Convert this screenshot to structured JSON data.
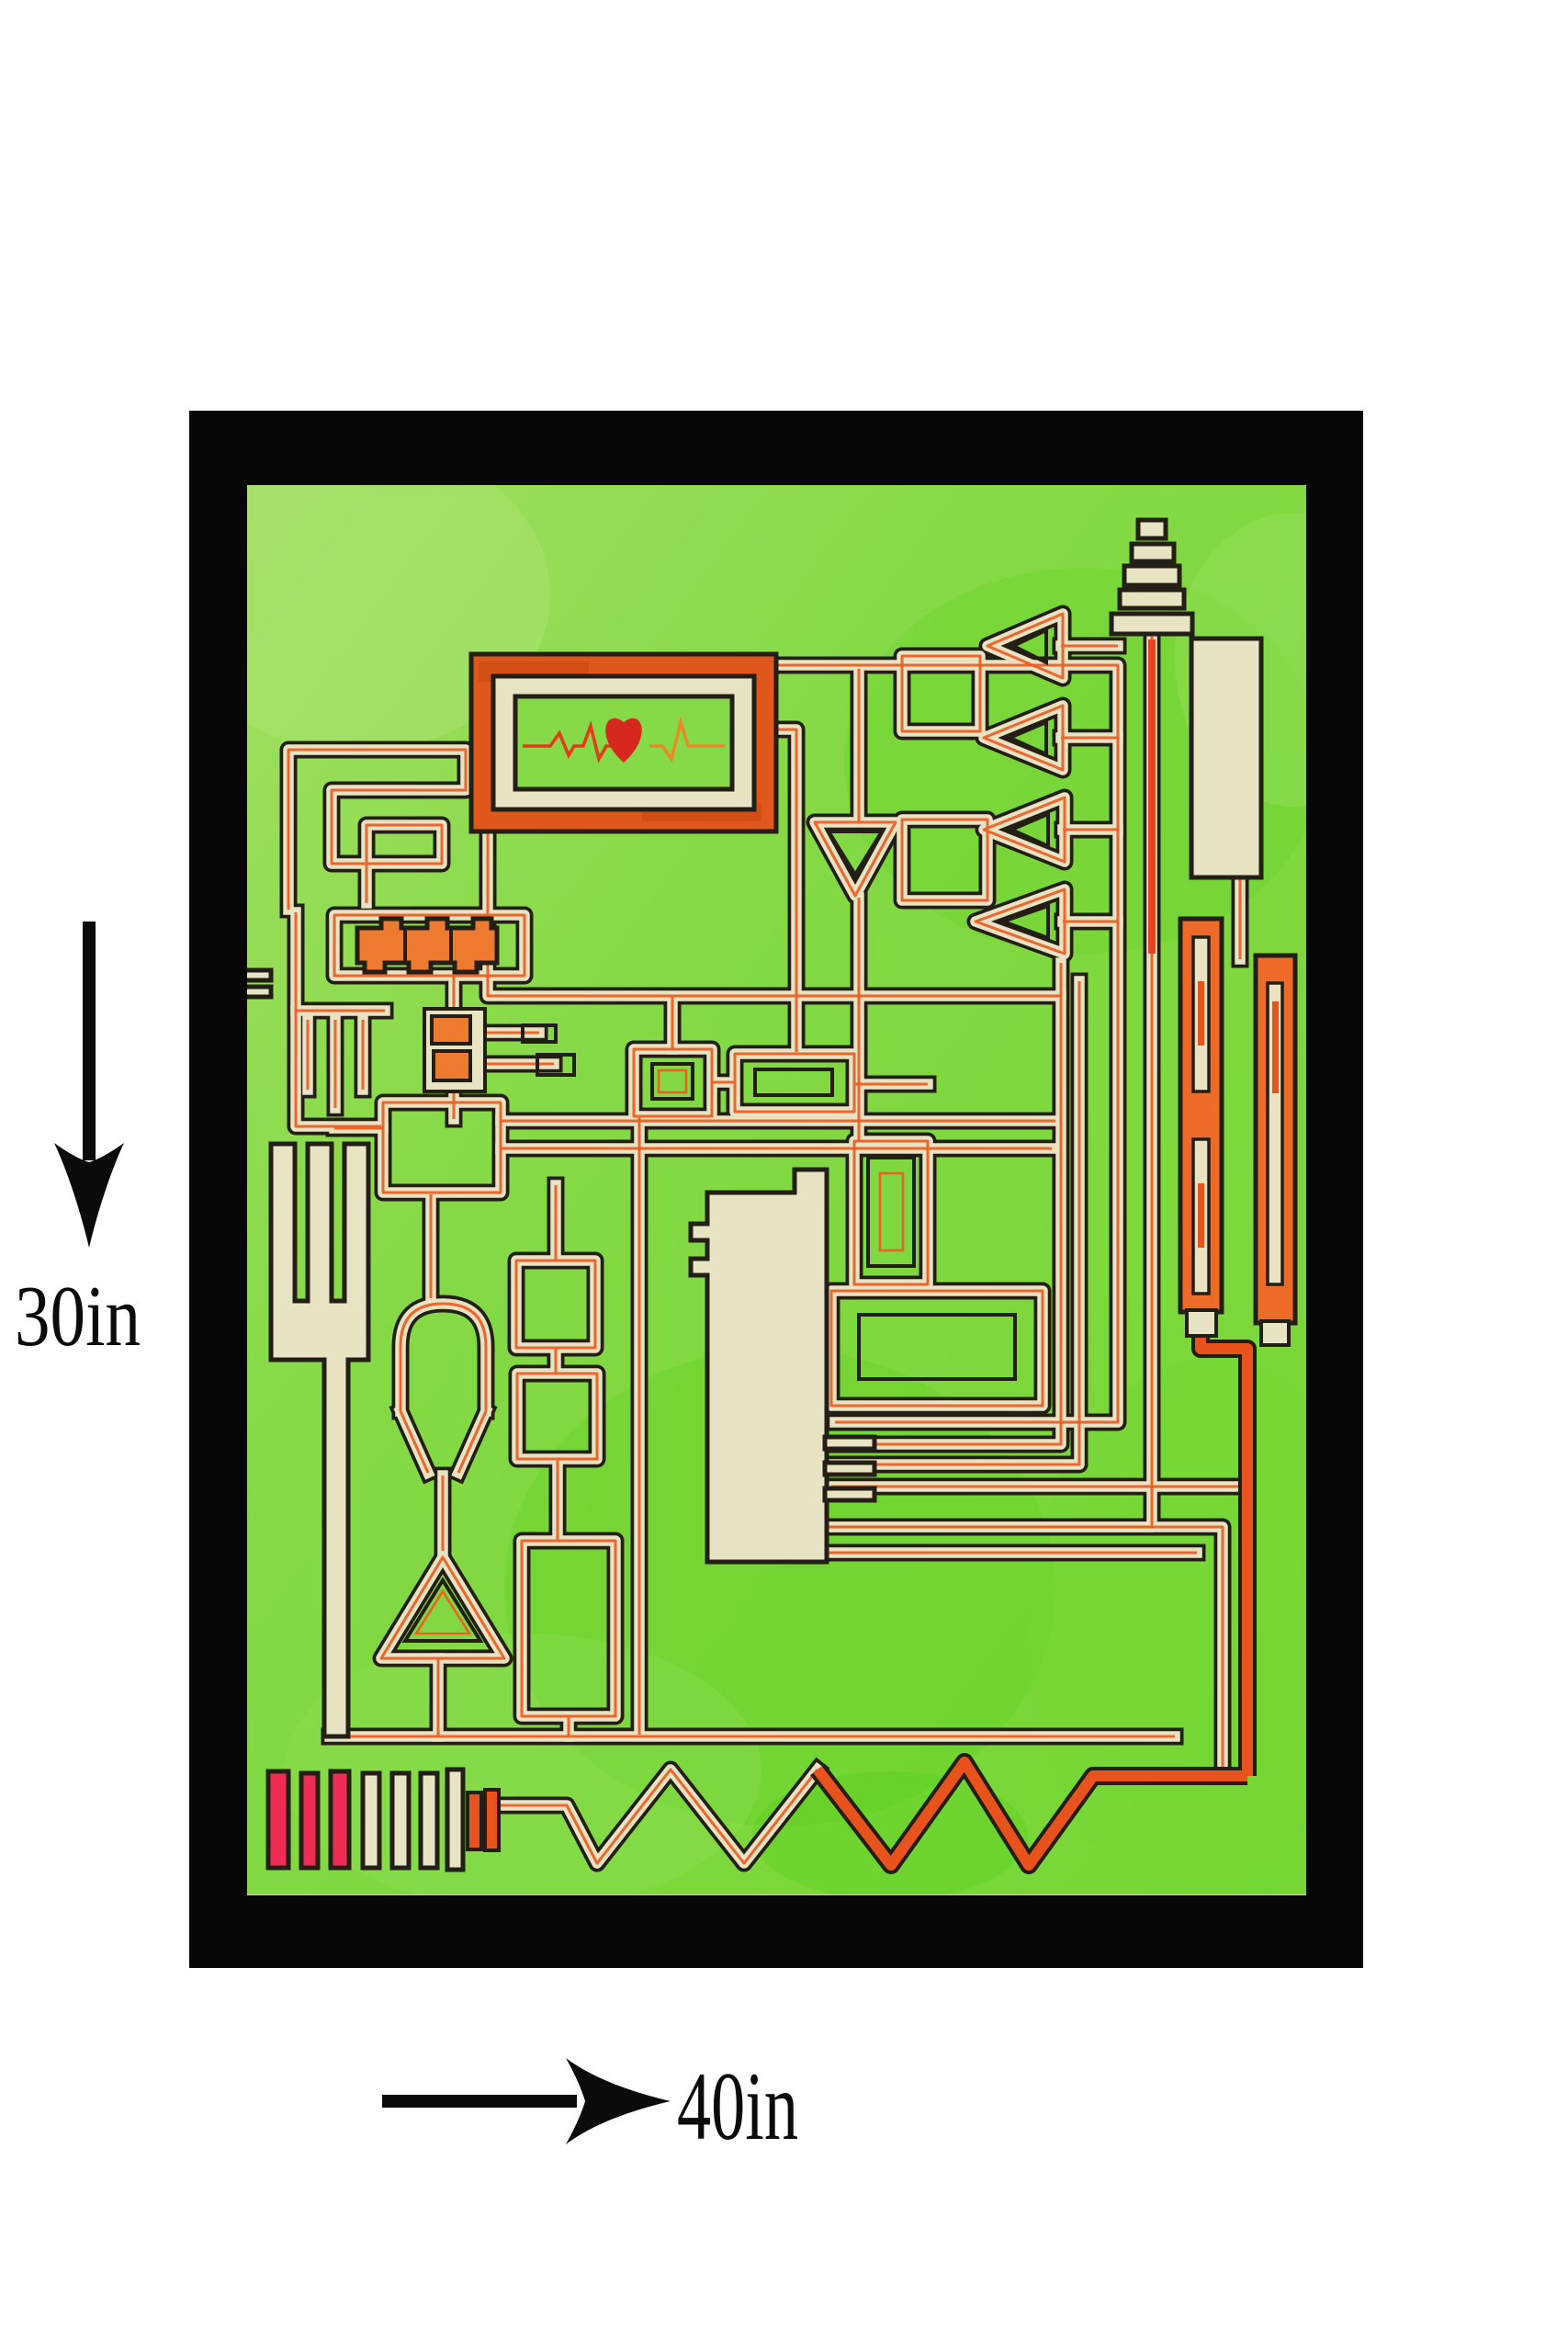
{
  "dimensions": {
    "height_label": "30in",
    "width_label": "40in"
  },
  "icons": [
    "down-arrow-icon",
    "right-arrow-icon",
    "heart-icon",
    "ekg-line",
    "antenna-icon",
    "zigzag-trace",
    "barcode-bars"
  ],
  "artwork": {
    "frame_color": "#070707",
    "background_green": "#84d944",
    "background_green_light": "#9ade5e",
    "trace_cream": "#e7e3c3",
    "trace_outline_black": "#241f16",
    "trace_orange": "#f05a22",
    "accent_orange_fill": "#ee6a28",
    "accent_red_pink": "#ee2d55",
    "heart_red": "#d6281e",
    "monitor_frame_orange": "#e0571b"
  }
}
